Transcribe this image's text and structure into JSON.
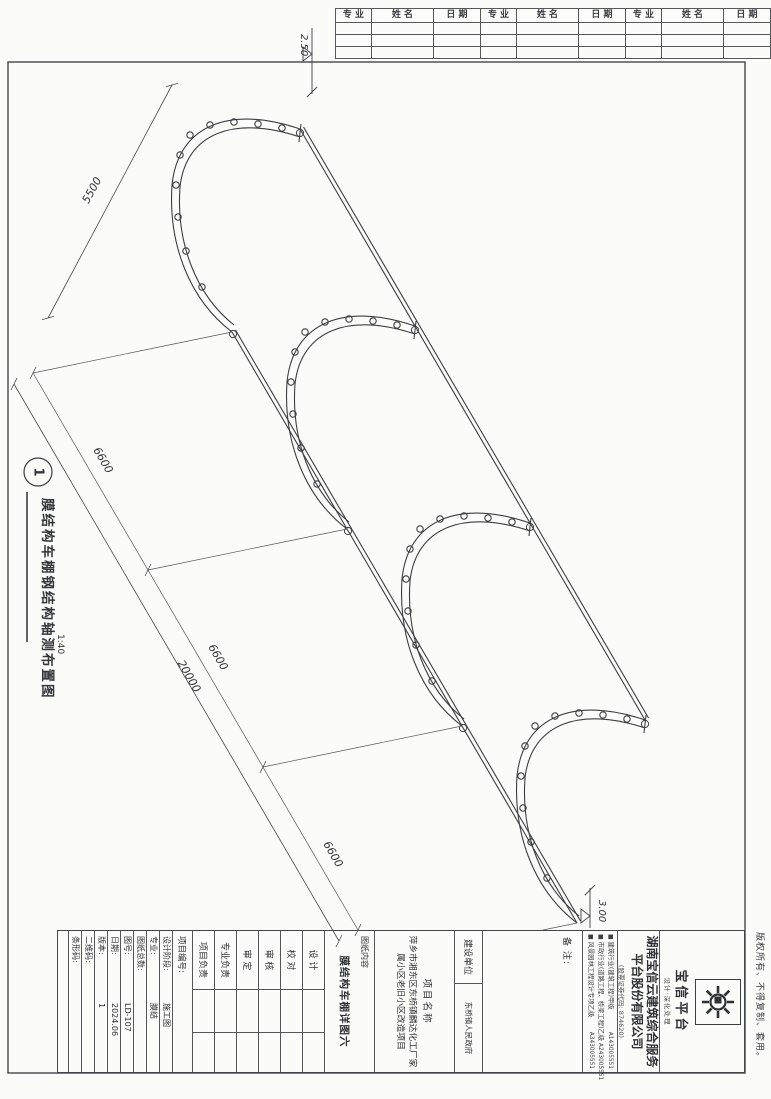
{
  "signoff_table": {
    "headers": [
      "专 业",
      "姓 名",
      "日 期",
      "专 业",
      "姓 名",
      "日 期",
      "专 业",
      "姓 名",
      "日 期"
    ]
  },
  "drawing": {
    "figure_number": "1",
    "title": "膜结构车棚钢结构轴测布置图",
    "scale": "1:40",
    "dims": {
      "width": "5500",
      "bay": "6600",
      "total": "20000"
    },
    "elevations": {
      "top": "2.50",
      "bottom": "3.00"
    }
  },
  "title_block": {
    "copyright": "版权所有、不得复制、套用。",
    "cert_bullet": "■",
    "logo": {
      "name": "宝信平台",
      "tagline": "设计·深化处理",
      "icon": "gear-starburst"
    },
    "company": {
      "name": "湖南宝信云建筑综合服务平台股份有限公司",
      "stock": "(股票证券代码: 874620)"
    },
    "certificates": [
      {
        "text": "建筑行业(建筑工程)甲级",
        "code": "A143005551"
      },
      {
        "text": "市政行业(道路工程、桥梁工程)乙级",
        "code": "A243005551"
      },
      {
        "text": "风景园林工程设计专项乙级",
        "code": "A343005551"
      }
    ],
    "remark_label": "备 注:",
    "client": {
      "label": "建设单位",
      "value": "东桥镇人民政府"
    },
    "project": {
      "label": "项目名称",
      "value": "萍乡市湘东区东桥镇麟达化工厂家属小区老旧小区改造项目"
    },
    "content": {
      "label": "图纸内容",
      "value": "膜结构车棚详图六"
    },
    "signatures": [
      {
        "label": "设 计"
      },
      {
        "label": "校 对"
      },
      {
        "label": "审 核"
      },
      {
        "label": "审 定"
      },
      {
        "label": "专业负责"
      },
      {
        "label": "项目负责"
      }
    ],
    "fields": [
      {
        "label": "项目编号:",
        "value": ""
      },
      {
        "label": "设计阶段:",
        "value": "施工图"
      },
      {
        "label": "专业:",
        "value": "膜结"
      },
      {
        "label": "图纸总数:",
        "value": ""
      },
      {
        "label": "图号:",
        "value": "LD-107"
      },
      {
        "label": "日期:",
        "value": "2024.06"
      },
      {
        "label": "版本:",
        "value": "1"
      },
      {
        "label": "二维码:",
        "value": ""
      },
      {
        "label": "条形码:",
        "value": ""
      }
    ]
  }
}
